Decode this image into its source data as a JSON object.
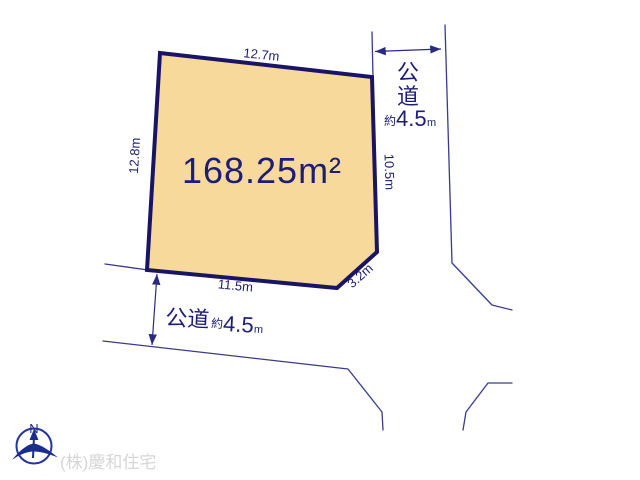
{
  "diagram": {
    "plot": {
      "area": "168.25m²",
      "dim_top": "12.7m",
      "dim_left": "12.8m",
      "dim_right": "10.5m",
      "dim_bottom": "11.5m",
      "dim_corner": "3.2m"
    },
    "road_right": {
      "name_char_top": "公",
      "name_char_bottom": "道",
      "approx": "約",
      "width": "4.5",
      "unit": "m"
    },
    "road_bottom": {
      "name": "公道",
      "approx": "約",
      "width": "4.5",
      "unit": "m"
    },
    "compass": {
      "north": "N"
    },
    "company": "(株)慶和住宅",
    "colors": {
      "plot_fill": "#F6D99B",
      "plot_border": "#1A1464",
      "line": "#3A3A8C",
      "text": "#1D1D75",
      "company_text": "#D6D6D6"
    }
  }
}
